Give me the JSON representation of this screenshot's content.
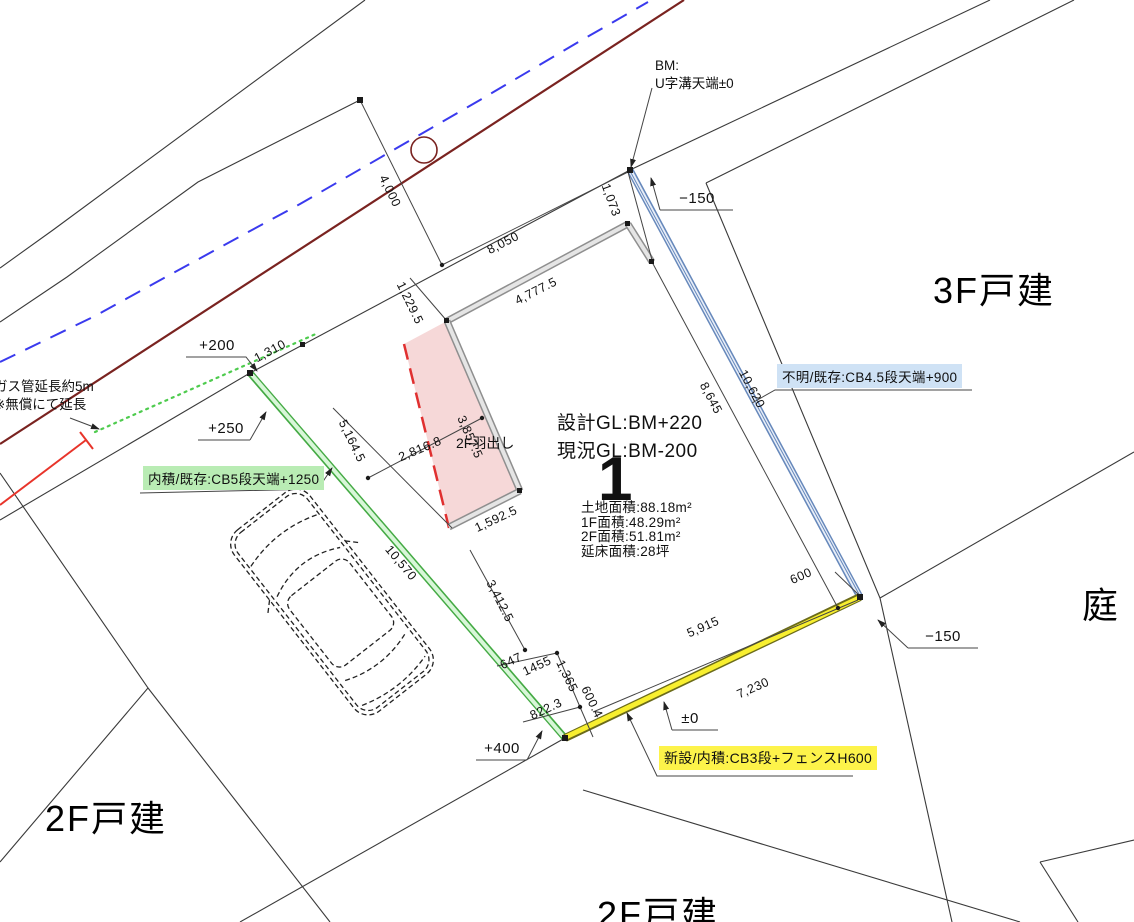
{
  "drawing": {
    "benchmark": {
      "line1": "BM:",
      "line2": "U字溝天端±0"
    },
    "gl": {
      "design": "設計GL:BM+220",
      "current": "現況GL:BM-200"
    },
    "lot_number": "1",
    "areas": {
      "land": "土地面積:88.18m²",
      "f1": "1F面積:48.29m²",
      "f2": "2F面積:51.81m²",
      "total": "延床面積:28坪"
    },
    "overhang_label": "2F羽出し",
    "gas_note": {
      "line1": "ガス管延長約5m",
      "line2": "※無償にて延長"
    },
    "wall_labels": {
      "green": "内積/既存:CB5段天端+1250",
      "blue": "不明/既存:CB4.5段天端+900",
      "yellow": "新設/内積:CB3段+フェンスH600"
    },
    "parcels": {
      "ne": "3F戸建",
      "east": "庭",
      "sw": "2F戸建",
      "south": "2F戸建"
    },
    "levels": [
      {
        "text": "+200",
        "x": 217,
        "y": 354
      },
      {
        "text": "+250",
        "x": 226,
        "y": 437
      },
      {
        "text": "+400",
        "x": 502,
        "y": 757
      },
      {
        "text": "±0",
        "x": 690,
        "y": 727
      },
      {
        "text": "−150",
        "x": 697,
        "y": 207
      },
      {
        "text": "−150",
        "x": 943,
        "y": 645
      }
    ],
    "dimensions": [
      {
        "text": "4,000",
        "x": 390,
        "y": 191,
        "rot": 64
      },
      {
        "text": "8,050",
        "x": 503,
        "y": 243,
        "rot": -27
      },
      {
        "text": "1,073",
        "x": 611,
        "y": 200,
        "rot": 70
      },
      {
        "text": "1,310",
        "x": 270,
        "y": 351,
        "rot": -28
      },
      {
        "text": "1,229.5",
        "x": 410,
        "y": 303,
        "rot": 64
      },
      {
        "text": "4,777.5",
        "x": 536,
        "y": 291,
        "rot": -27
      },
      {
        "text": "3,857.5",
        "x": 470,
        "y": 437,
        "rot": 66
      },
      {
        "text": "5,164.5",
        "x": 352,
        "y": 441,
        "rot": 64
      },
      {
        "text": "2,816.8",
        "x": 420,
        "y": 449,
        "rot": -23
      },
      {
        "text": "1,592.5",
        "x": 496,
        "y": 519,
        "rot": -25
      },
      {
        "text": "3,412.5",
        "x": 500,
        "y": 601,
        "rot": 63
      },
      {
        "text": "10,570",
        "x": 401,
        "y": 563,
        "rot": 50
      },
      {
        "text": "647",
        "x": 511,
        "y": 661,
        "rot": -25
      },
      {
        "text": "1455",
        "x": 537,
        "y": 666,
        "rot": -25
      },
      {
        "text": "1,365",
        "x": 567,
        "y": 676,
        "rot": 64
      },
      {
        "text": "822.3",
        "x": 546,
        "y": 709,
        "rot": -25
      },
      {
        "text": "600.4",
        "x": 592,
        "y": 702,
        "rot": 64
      },
      {
        "text": "5,915",
        "x": 703,
        "y": 627,
        "rot": -24
      },
      {
        "text": "7,230",
        "x": 753,
        "y": 688,
        "rot": -24
      },
      {
        "text": "600",
        "x": 801,
        "y": 576,
        "rot": -24
      },
      {
        "text": "8,645",
        "x": 711,
        "y": 398,
        "rot": 62
      },
      {
        "text": "10,620",
        "x": 752,
        "y": 389,
        "rot": 62
      }
    ],
    "colors": {
      "road": "#7a2320",
      "centerline": "#3a3aee",
      "gas-red": "#e8342a",
      "gas-green": "#4ecb4e",
      "green-wall": "#44aa44",
      "green-wall-fill": "#d8f7d8",
      "blue-wall": "#6688bb",
      "blue-wall-fill": "#e8eef8",
      "yellow-wall-edge": "#6b6b1a",
      "yellow-wall-fill": "#f8ef2f",
      "overhang-fill": "#f6d8d8",
      "overhang-edge": "#e03030",
      "building-wall": "#8f8f8f",
      "building-wall-fill": "#e5e5e5",
      "label-green-bg": "#b9ecb4",
      "label-blue-bg": "#cfe2f5",
      "label-yellow-bg": "#fdf34a"
    }
  }
}
